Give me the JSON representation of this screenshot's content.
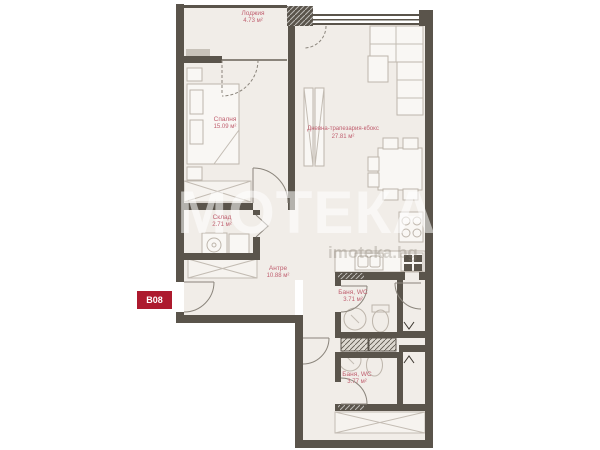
{
  "plan": {
    "badge": "B08",
    "watermark": {
      "brand": "ИМОТЕКА",
      "domain": "imoteka.bg"
    },
    "rooms": {
      "loggia": {
        "name": "Лоджия",
        "area": "4.73 м²"
      },
      "bedroom": {
        "name": "Спалня",
        "area": "15.09 м²"
      },
      "living": {
        "name": "Дневна-трапезария-кбокс",
        "area": "27.81 м²"
      },
      "storage": {
        "name": "Склад",
        "area": "2.71 м²"
      },
      "hallway": {
        "name": "Антре",
        "area": "10.88 м²"
      },
      "bath_upper": {
        "name": "Баня, WC",
        "area": "3.71 м²"
      },
      "bath_lower": {
        "name": "Баня, WC",
        "area": "3.77 м²"
      }
    },
    "colors": {
      "wall": "#5a544b",
      "floor": "#f1ede8",
      "label": "#c06070",
      "badge_bg": "#ad1a2e",
      "badge_text": "#ffffff"
    }
  }
}
